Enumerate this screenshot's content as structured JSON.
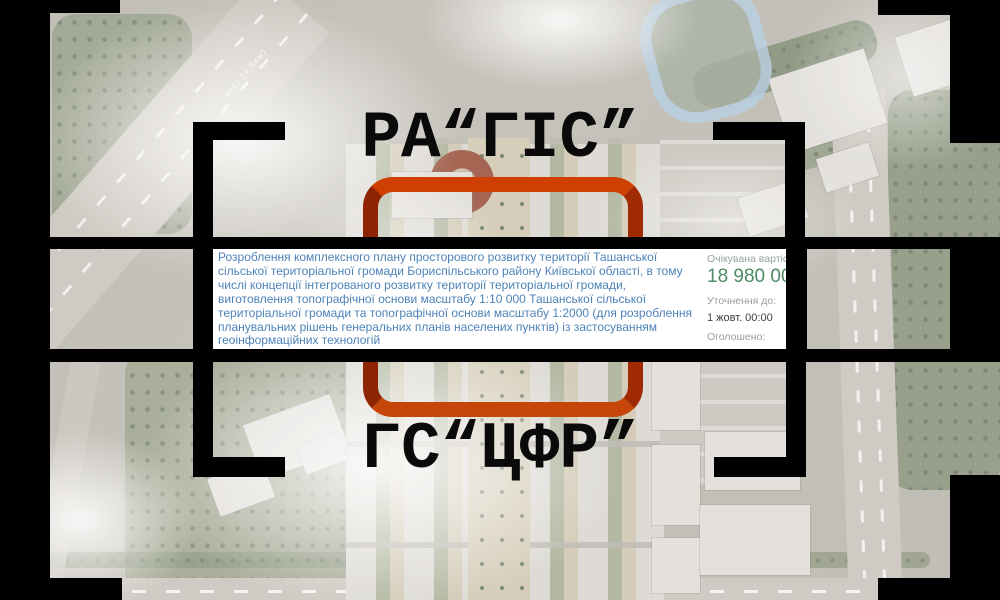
{
  "titles": {
    "top": "РА“ГІС”",
    "bottom": "ГС“ЦФР”"
  },
  "tender_card": {
    "description": "Розроблення комплексного плану просторового розвитку території Ташанської сільської територіальної громади Бориспільського району Київської області, в тому числі концепції інтегрованого розвитку території територіальної громади, виготовлення топографічної основи масштабу 1:10 000 Ташанської сільської територіальної громади та топографічної основи масштабу 1:2000 (для розроблення планувальних рішень генеральних планів населених пунктів) із застосуванням геоінформаційних технологій",
    "expected_value": {
      "label": "Очікувана вартість",
      "amount": "18 980 000,"
    },
    "clarification": {
      "label": "Уточнення до:",
      "value": "1 жовт. 00:00"
    },
    "announced": {
      "label": "Оголошено:",
      "value": "25 вер. 2025"
    }
  },
  "map": {
    "road_label": "міст (4,5км)"
  },
  "colors": {
    "frame_black": "#000000",
    "highlight_red": "#b23000",
    "description_blue": "#4d82b8",
    "amount_green": "#4e8a63",
    "label_gray_green": "#97a39b",
    "label_gray": "#9b9b9b",
    "track_blue": "#a9c9e2"
  }
}
